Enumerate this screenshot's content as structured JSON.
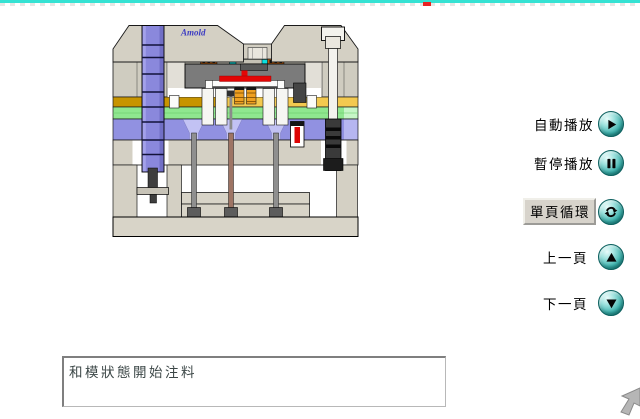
{
  "stage": {
    "border_color": "#35e2d3",
    "progress_marker_color": "#e82222"
  },
  "diagram": {
    "logo": "Amold",
    "colors": {
      "frame": "#d4d0c4",
      "frame2": "#cfccc0",
      "plate_fill": "#d8d4c8",
      "core": "#7b7b7b",
      "melt_red": "#e30505",
      "gold_dark": "#c79400",
      "gold_light": "#f3c94f",
      "green": "#8fe78f",
      "lavender": "#9191e1",
      "column_blue": "#8a88dc",
      "cyan_accent": "#0ce0e0",
      "heater_orange": "#b85c10",
      "spring_orange": "#efa021"
    }
  },
  "controls": {
    "icon_color": "#3db3ae",
    "items": [
      {
        "label": "自動播放",
        "icon": "play"
      },
      {
        "label": "暫停播放",
        "icon": "pause"
      },
      {
        "label": "單頁循環",
        "icon": "loop"
      },
      {
        "label": "上一頁",
        "icon": "up-arrow"
      },
      {
        "label": "下一頁",
        "icon": "down-arrow"
      }
    ]
  },
  "status_box": {
    "text": "和模狀態開始注料"
  }
}
